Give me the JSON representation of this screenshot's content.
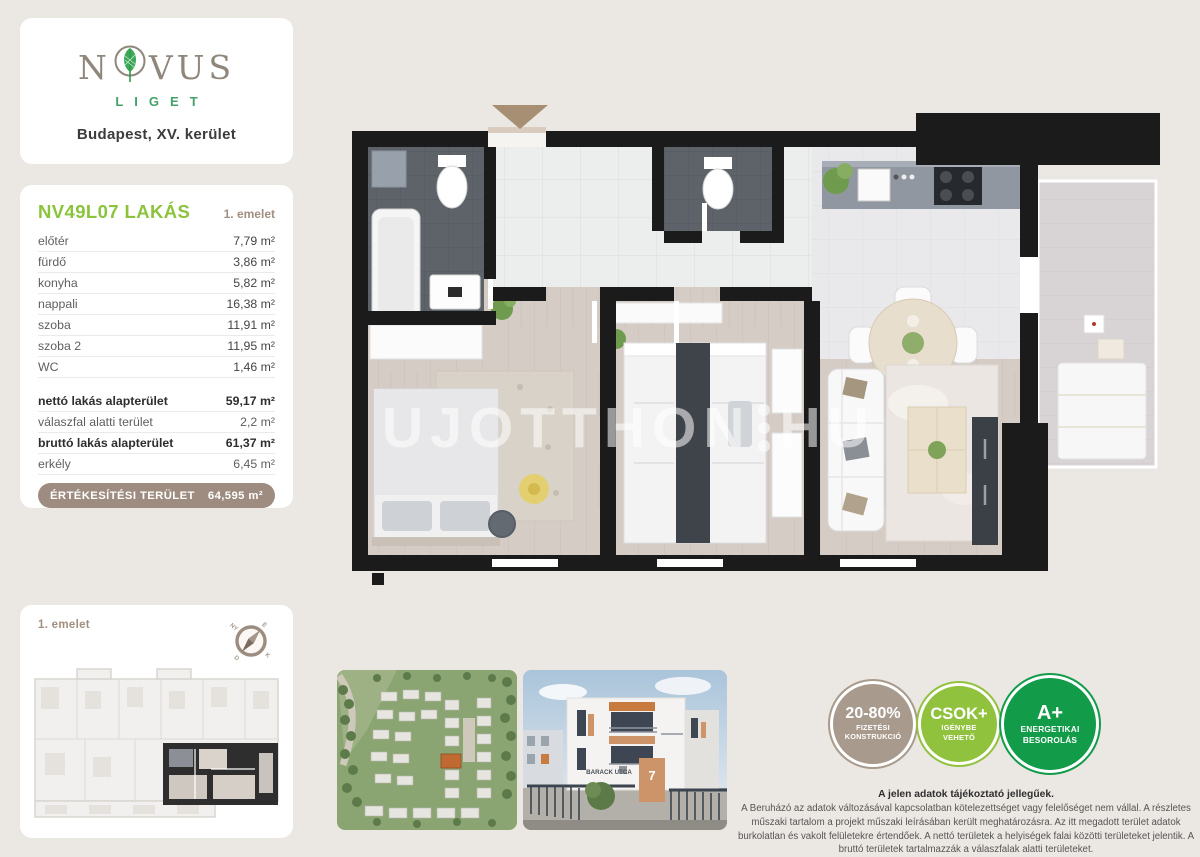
{
  "colors": {
    "page_bg": "#ebe7e2",
    "brand_green": "#44a16c",
    "title_green": "#8bc43c",
    "label_brown": "#a18f80",
    "pill_brown": "#9d8c7f",
    "badge_taupe": "#a89b8d",
    "badge_light_green": "#90c23e",
    "badge_dark_green": "#129b49",
    "wall_black": "#1b1b1b"
  },
  "logo": {
    "brand_left": "N",
    "brand_right": "VUS",
    "brand_sub": "LIGET",
    "location": "Budapest, XV. kerület"
  },
  "unit": {
    "title": "NV49L07 LAKÁS",
    "floor": "1. emelet",
    "rooms": [
      {
        "label": "előtér",
        "area": "7,79 m²"
      },
      {
        "label": "fürdő",
        "area": "3,86 m²"
      },
      {
        "label": "konyha",
        "area": "5,82 m²"
      },
      {
        "label": "nappali",
        "area": "16,38 m²"
      },
      {
        "label": "szoba",
        "area": "11,91 m²"
      },
      {
        "label": "szoba 2",
        "area": "11,95 m²"
      },
      {
        "label": "WC",
        "area": "1,46 m²"
      }
    ],
    "summary": [
      {
        "label": "nettó lakás alapterület",
        "area": "59,17 m²"
      },
      {
        "label": "válaszfal alatti terület",
        "area": "2,2 m²"
      },
      {
        "label": "bruttó lakás alapterület",
        "area": "61,37 m²"
      },
      {
        "label": "erkély",
        "area": "6,45 m²"
      }
    ],
    "total": {
      "label": "ÉRTÉKESÍTÉSI TERÜLET",
      "area": "64,595 m²"
    }
  },
  "overview": {
    "floor_label": "1. emelet",
    "compass": {
      "n": "É",
      "e": "K",
      "s": "D",
      "w": "NY"
    }
  },
  "plan": {
    "watermark_left": "UJOTTHON",
    "watermark_right": "HU"
  },
  "building_photo": {
    "street_sign": "BARACK UTCA",
    "house_number": "7"
  },
  "badges": [
    {
      "value": "20-80%",
      "line1": "FIZETÉSI",
      "line2": "KONSTRUKCIÓ",
      "color": "#a89b8d"
    },
    {
      "value": "CSOK+",
      "line1": "IGÉNYBE",
      "line2": "VEHETŐ",
      "color": "#90c23e"
    },
    {
      "value": "A+",
      "line1": "ENERGETIKAI",
      "line2": "BESOROLÁS",
      "color": "#129b49"
    }
  ],
  "disclaimer": {
    "title": "A jelen adatok tájékoztató jellegűek.",
    "body": "A Beruházó az adatok változásával kapcsolatban kötelezettséget vagy felelőséget nem vállal. A részletes műszaki tartalom a projekt műszaki leírásában került meghatározásra. Az itt megadott terület adatok burkolatlan és vakolt felületekre értendőek. A nettó területek a helyiségek falai közötti területeket jelentik. A bruttó területek tartalmazzák a válaszfalak alatti területeket."
  }
}
